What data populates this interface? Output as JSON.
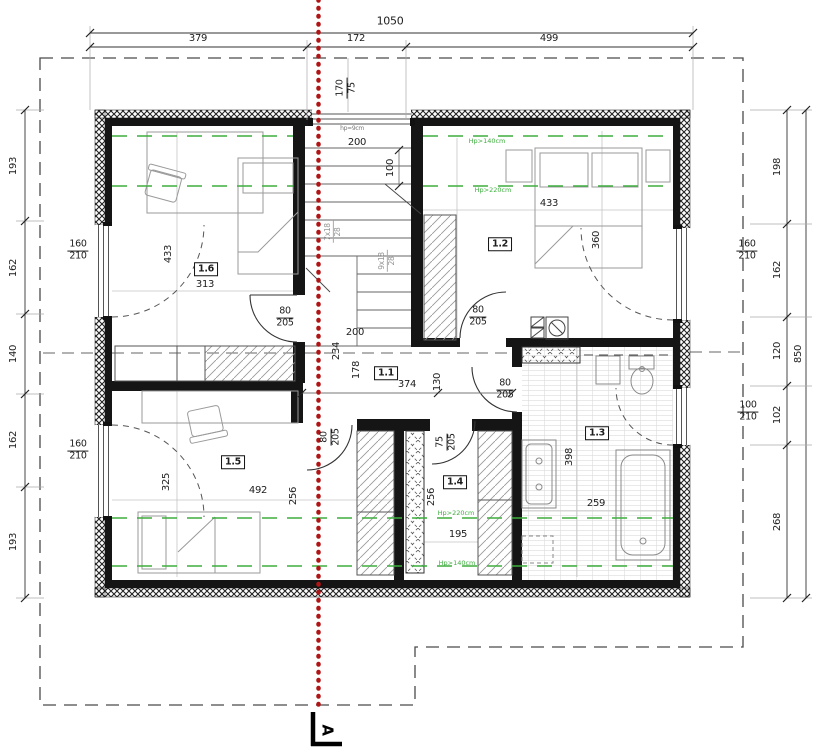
{
  "section": {
    "label": "A"
  },
  "colors": {
    "section_line": "#b11414",
    "height_line": "#3fae3f"
  },
  "dims": {
    "top": {
      "total": "1050",
      "segments": [
        "379",
        "172",
        "499"
      ]
    },
    "left": [
      "193",
      "162",
      "140",
      "162",
      "193"
    ],
    "right": {
      "segments": [
        "198",
        "162",
        "120",
        "102",
        "268"
      ],
      "total": "850"
    },
    "top_window": {
      "w": "170",
      "h": "75",
      "sill_note": "hp=9cm"
    }
  },
  "stairs": {
    "width": "200",
    "entry": "100",
    "flight_upper": {
      "steps": "7x18",
      "tread": "28"
    },
    "flight_lower": {
      "steps": "9x18",
      "tread": "28"
    }
  },
  "hall": {
    "label": "1.1",
    "d200": "200",
    "d234": "234",
    "d178": "178",
    "d374": "374",
    "d130": "130"
  },
  "rooms": {
    "r16": {
      "label": "1.6",
      "depth": "433",
      "width": "313"
    },
    "r12": {
      "label": "1.2",
      "width": "433",
      "depth": "360"
    },
    "r15": {
      "label": "1.5",
      "depth": "325",
      "width": "492",
      "depth2": "256"
    },
    "r14": {
      "label": "1.4",
      "depth": "256",
      "width": "195"
    },
    "r13": {
      "label": "1.3",
      "depth": "398",
      "width": "259"
    }
  },
  "doors": {
    "room16": {
      "w": "80",
      "h": "205"
    },
    "room12": {
      "w": "80",
      "h": "205"
    },
    "room13": {
      "w": "80",
      "h": "205"
    },
    "room15": {
      "w": "80",
      "h": "205"
    },
    "room14": {
      "w": "75",
      "h": "205"
    }
  },
  "windows": {
    "left_top": {
      "w": "160",
      "h": "210"
    },
    "left_bottom": {
      "w": "160",
      "h": "210"
    },
    "right_top": {
      "w": "160",
      "h": "210"
    },
    "right_bottom": {
      "w": "100",
      "h": "210"
    }
  },
  "height_lines": {
    "north_140": "Hp>140cm",
    "north_220": "Hp>220cm",
    "south_220": "Hp>220cm",
    "south_140": "Hp>140cm"
  }
}
